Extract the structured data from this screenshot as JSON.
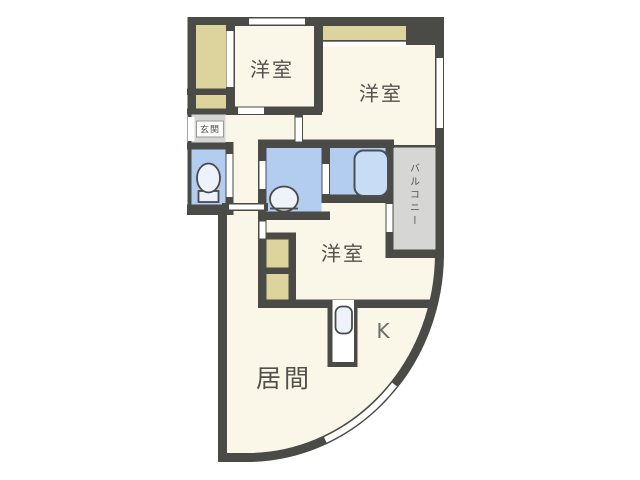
{
  "floorplan": {
    "type": "apartment-floor-plan",
    "labels": {
      "bedroom_top_left": "洋室",
      "bedroom_top_right": "洋室",
      "bedroom_middle": "洋室",
      "living_room": "居間",
      "kitchen": "K",
      "entrance": "玄関",
      "balcony": "バルコニー"
    },
    "fixtures": [
      "toilet",
      "washbasin",
      "bathtub",
      "kitchen-sink"
    ],
    "colors": {
      "wall": "#4a4a46",
      "floor": "#faf6e8",
      "wet": "#b3cdf1",
      "closet": "#dcd49c",
      "gray": "#d6d6d4",
      "window": "#ffffff",
      "fixture": "#eef3fb",
      "tub": "#c9dcf6"
    }
  }
}
